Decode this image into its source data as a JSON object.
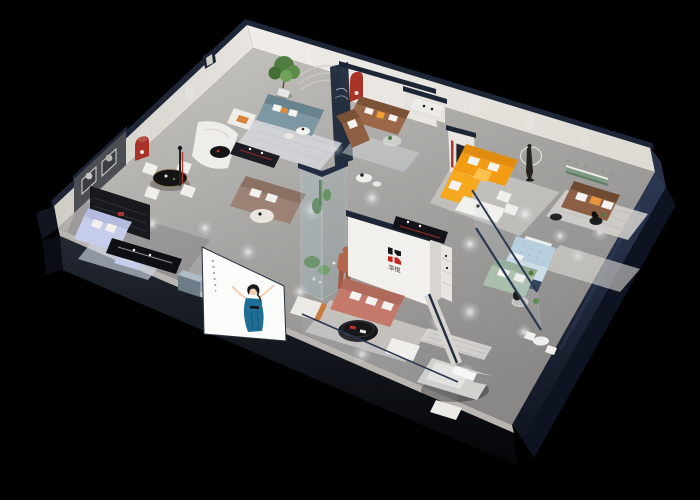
{
  "scene": {
    "type": "3d-isometric-cutaway-render",
    "description": "Dollhouse cutaway view of a furniture showroom apartment, photoreal 3D render on black background",
    "background": "#000000"
  },
  "brand": {
    "logo_characters": "华悦",
    "back_wall_lettering": "H U A Y U E",
    "logo_red": "#c3261f",
    "logo_black": "#141414"
  },
  "palette": {
    "background": "#000000",
    "wall_navy": "#232d42",
    "wall_navy_dark": "#131a29",
    "wall_interior": "#e9e6e1",
    "wall_interior_shadow": "#d9d6d0",
    "floor_light": "#c9c7c3",
    "floor_dark": "#8e8c89",
    "sofa_teal": "#7e98a3",
    "sofa_brown": "#9a6848",
    "sofa_brown_dark": "#8d6046",
    "sofa_orange": "#f39c13",
    "sofa_orange_lit": "#ffc14e",
    "sofa_terracotta": "#c4796a",
    "sofa_periwinkle": "#c6cdea",
    "sofa_sage": "#a9bfab",
    "daybed_blue": "#b6cede",
    "niche_red": "#a93327",
    "shelf_green": "#7e9b85",
    "plant_green": "#4e7d3f",
    "mannequin_terracotta": "#b4664c",
    "poster_dress_blue": "#1e6e95"
  },
  "rooms": [
    {
      "id": "lounge-teal",
      "label": "back-left lounge",
      "furniture": [
        "teal fabric sofa",
        "white armchair with orange cushion",
        "potted tree",
        "round coffee tables",
        "striped rug",
        "arc mural wall"
      ]
    },
    {
      "id": "lounge-brown",
      "label": "back-center lounge",
      "furniture": [
        "two brown leather loveseats",
        "glass coffee table",
        "white credenza",
        "red arched wall niche",
        "small wall text"
      ]
    },
    {
      "id": "lounge-orange",
      "label": "right showroom bay",
      "furniture": [
        "orange L-sectional sofa",
        "white dining table with chairs",
        "dark art panel",
        "figure sculpture with light ring"
      ]
    },
    {
      "id": "lounge-sage",
      "label": "right front bay",
      "furniture": [
        "sage green sofa",
        "tufted light-blue daybed",
        "white side table",
        "glass round table",
        "glass partition"
      ]
    },
    {
      "id": "showroom-center",
      "label": "central showroom",
      "furniture": [
        "terracotta sofa with white pillows",
        "black oval coffee table",
        "white ottoman",
        "white armchair with orange side",
        "brand logo wall",
        "glass plant case with cacti",
        "terracotta mannequin",
        "black media console"
      ]
    },
    {
      "id": "lounge-periwinkle",
      "label": "left corner room",
      "furniture": [
        "periwinkle sofa set",
        "dark media shelf wall",
        "black display bench",
        "light blue rug"
      ]
    },
    {
      "id": "dining",
      "label": "left dining corner",
      "furniture": [
        "black oval dining table",
        "four white chairs",
        "dark gallery wall with two framed artworks",
        "red arched niche",
        "black floor lamp with red stripe"
      ]
    },
    {
      "id": "bedroom-front",
      "label": "front bedroom display",
      "furniture": [
        "gray bed with white pillows",
        "white bench",
        "striped rug",
        "small white table with chairs"
      ]
    }
  ],
  "storefront": {
    "poster": {
      "description": "white storefront panel with illustrated woman in blue dress, vertical caption marks",
      "dress_color": "#1e6e95"
    },
    "items": [
      "gray cube ottoman",
      "glass balustrade"
    ]
  }
}
